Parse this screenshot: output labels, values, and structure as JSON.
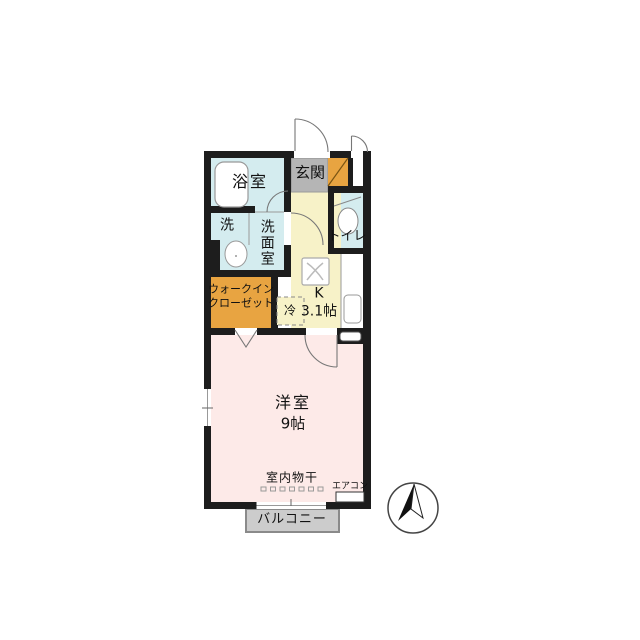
{
  "floorplan": {
    "rooms": {
      "bath": {
        "label": "浴室"
      },
      "entrance": {
        "label": "玄関"
      },
      "toilet": {
        "label": "トイレ"
      },
      "laundry_nook": {
        "label": "洗"
      },
      "washroom": {
        "label": "洗面室"
      },
      "walk_in_closet": {
        "label_line1": "ウォークイン",
        "label_line2": "クローゼット"
      },
      "kitchen": {
        "label": "K",
        "size": "3.1帖"
      },
      "refrigerator": {
        "label": "冷"
      },
      "western_room": {
        "label": "洋室",
        "size": "9帖"
      },
      "balcony": {
        "label": "バルコニー"
      }
    },
    "annotations": {
      "indoor_drying": "室内物干",
      "air_conditioner": "エアコン"
    },
    "colors": {
      "wall": "#1d1d1d",
      "water_rooms": "#d4ecef",
      "entrance_floor": "#b5b5b5",
      "storage_orange": "#e8a441",
      "kitchen_floor": "#f7f2c8",
      "room_floor": "#fdeae8",
      "balcony_floor": "#cccccc"
    },
    "icons": {
      "compass": "north-arrow"
    }
  }
}
